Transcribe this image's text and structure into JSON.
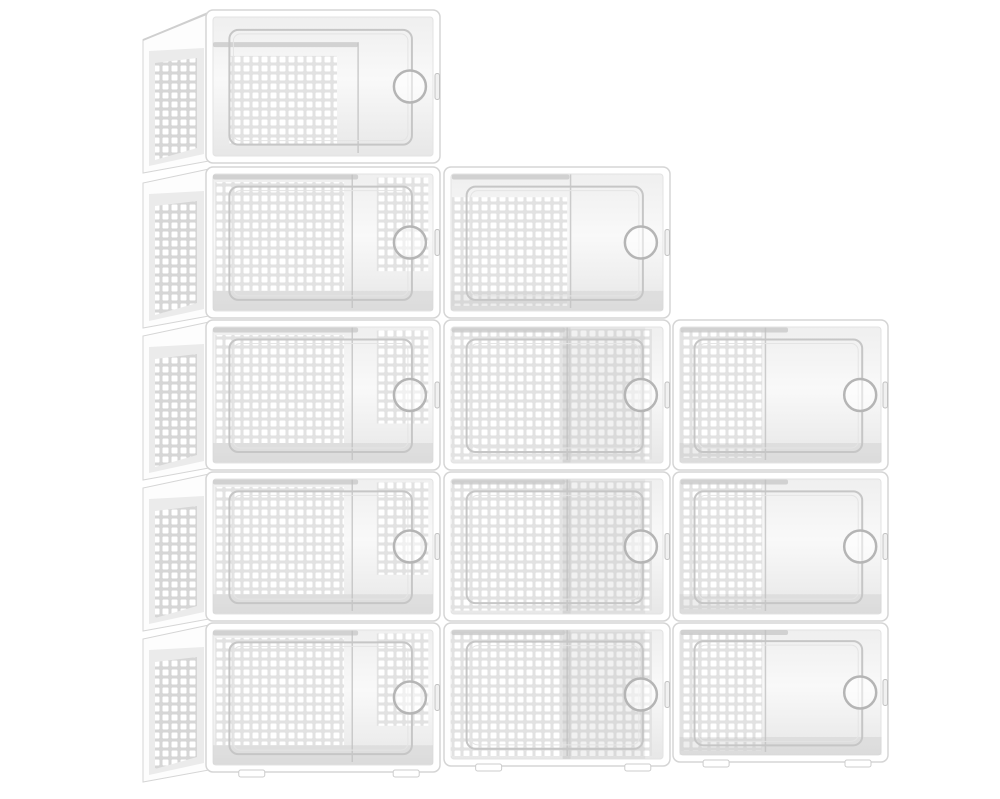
{
  "scene": {
    "kind": "product-photo",
    "subject": "stackable-clear-shoe-storage-boxes",
    "box_count": 12,
    "width": 1000,
    "height": 799,
    "colors": {
      "bg": "#ffffff",
      "frame": "#ffffff",
      "frameEdge": "#d5d5d5",
      "interiorTop": "#efefef",
      "interiorMid": "#f9f9f9",
      "interiorBot": "#e7e7e7",
      "perfGap": "#e2e2e2",
      "perfHole": "#ffffff",
      "sideGap": "#d6d6d6",
      "panelGray": "#ebebeb",
      "doorLine": "#c6c6c6",
      "doorLineInner": "#e4e4e4",
      "band": "#c9c9c9",
      "vline": "#c2c2c2",
      "handle": "#b5b5b5",
      "latchFill": "#f1f1f1",
      "latchEdge": "#c2c2c2",
      "shade": "#c0c0c0",
      "foot": "#ffffff",
      "footEdge": "#cccccc",
      "sliverLine": "#cfcfcf"
    },
    "pattern": {
      "cell": 9,
      "hole": 6,
      "holeRadius": 1,
      "inset": 1.5
    },
    "door": {
      "fx": 0.1,
      "fy": 0.13,
      "fw": 0.78,
      "fh": 0.75,
      "radius": 9
    },
    "handle": {
      "r": 16,
      "strokeWidth": 2.5,
      "fillOpacity": 0.5
    },
    "latch": {
      "w": 4.5,
      "h": 26,
      "radius": 2
    },
    "feetFx": [
      0.14,
      0.8
    ],
    "sideDx": 63,
    "sideBottomDy": 10,
    "columns": [
      {
        "x": 206,
        "w": 234
      },
      {
        "x": 444,
        "w": 226
      },
      {
        "x": 673,
        "w": 215
      }
    ],
    "rows": [
      {
        "y": 10,
        "h": 153
      },
      {
        "y": 167,
        "h": 151
      },
      {
        "y": 320,
        "h": 150
      },
      {
        "y": 472,
        "h": 149
      },
      {
        "y": 623,
        "h": 149
      }
    ],
    "boxes": [
      {
        "col": 0,
        "row": 0,
        "side": true,
        "topSliver": true,
        "sideTopDy": 28,
        "band": [
          0.03,
          0.21,
          0.62
        ],
        "vline": 0.65,
        "perf": [
          [
            0.1,
            0.3,
            0.46,
            0.58
          ]
        ]
      },
      {
        "col": 0,
        "row": 1,
        "side": true,
        "sideTopDy": 14,
        "band": [
          0.03,
          0.05,
          0.62
        ],
        "vline": 0.625,
        "shadeB": true,
        "perf": [
          [
            0.04,
            0.1,
            0.55,
            0.72
          ],
          [
            0.73,
            0.07,
            0.22,
            0.62
          ]
        ]
      },
      {
        "col": 0,
        "row": 2,
        "side": true,
        "sideTopDy": 14,
        "band": [
          0.03,
          0.05,
          0.62
        ],
        "vline": 0.625,
        "shadeB": true,
        "perf": [
          [
            0.04,
            0.1,
            0.55,
            0.72
          ],
          [
            0.73,
            0.07,
            0.22,
            0.62
          ]
        ]
      },
      {
        "col": 0,
        "row": 3,
        "side": true,
        "sideTopDy": 14,
        "band": [
          0.03,
          0.05,
          0.62
        ],
        "vline": 0.625,
        "shadeB": true,
        "perf": [
          [
            0.04,
            0.1,
            0.55,
            0.72
          ],
          [
            0.73,
            0.07,
            0.22,
            0.62
          ]
        ]
      },
      {
        "col": 0,
        "row": 4,
        "side": true,
        "sideTopDy": 14,
        "feet": true,
        "band": [
          0.03,
          0.05,
          0.62
        ],
        "vline": 0.625,
        "shadeB": true,
        "perf": [
          [
            0.04,
            0.1,
            0.55,
            0.72
          ],
          [
            0.73,
            0.07,
            0.22,
            0.62
          ]
        ]
      },
      {
        "col": 1,
        "row": 1,
        "band": [
          0.035,
          0.05,
          0.52
        ],
        "vline": 0.56,
        "shadeB": true,
        "perf": [
          [
            0.035,
            0.2,
            0.51,
            0.72
          ]
        ]
      },
      {
        "col": 1,
        "row": 2,
        "band": [
          0.035,
          0.05,
          0.5
        ],
        "vline": 0.545,
        "midShade": true,
        "perf": [
          [
            0.03,
            0.06,
            0.89,
            0.87
          ]
        ]
      },
      {
        "col": 1,
        "row": 3,
        "band": [
          0.035,
          0.05,
          0.5
        ],
        "vline": 0.545,
        "midShade": true,
        "perf": [
          [
            0.03,
            0.06,
            0.89,
            0.87
          ]
        ]
      },
      {
        "col": 1,
        "row": 4,
        "hAdj": -6,
        "feet": true,
        "band": [
          0.035,
          0.05,
          0.5
        ],
        "vline": 0.545,
        "midShade": true,
        "perf": [
          [
            0.03,
            0.06,
            0.89,
            0.87
          ]
        ]
      },
      {
        "col": 2,
        "row": 2,
        "band": [
          0.035,
          0.05,
          0.5
        ],
        "vline": 0.43,
        "shadeB": true,
        "perf": [
          [
            0.035,
            0.07,
            0.38,
            0.85
          ]
        ]
      },
      {
        "col": 2,
        "row": 3,
        "band": [
          0.035,
          0.05,
          0.5
        ],
        "vline": 0.43,
        "shadeB": true,
        "perf": [
          [
            0.035,
            0.07,
            0.38,
            0.85
          ]
        ]
      },
      {
        "col": 2,
        "row": 4,
        "hAdj": -10,
        "feet": true,
        "band": [
          0.035,
          0.05,
          0.5
        ],
        "vline": 0.43,
        "shadeB": true,
        "perf": [
          [
            0.035,
            0.07,
            0.38,
            0.85
          ]
        ]
      }
    ]
  }
}
